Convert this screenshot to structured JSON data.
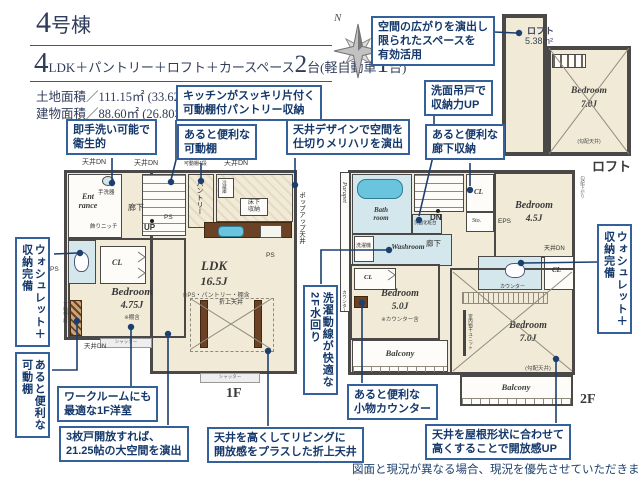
{
  "header": {
    "building_number": "4",
    "building_suffix": "号棟",
    "plan_num1": "4",
    "plan_text1": "LDK＋パントリー＋ロフト＋カースペース",
    "plan_num2": "2",
    "plan_text2": "台(軽自動車",
    "plan_num3": "1",
    "plan_text3": "台)",
    "land_area": "土地面積／111.15㎡ (33.62坪)",
    "building_area": "建物面積／88.60㎡ (26.80坪)"
  },
  "compass": {
    "north": "N"
  },
  "callouts": {
    "loft_space": "空間の広がりを演出し\n限られたスペースを\n有効活用",
    "kitchen_pantry": "キッチンがスッキリ片付く\n可動棚付パントリー収納",
    "washbasin_cabinet": "洗面吊戸で\n収納力UP",
    "handwash": "即手洗い可能で\n衛生的",
    "movable_shelf_top": "あると便利な\n可動棚",
    "ceiling_design": "天井デザインで空間を\n仕切りメリハリを演出",
    "hall_storage": "あると便利な\n廊下収納",
    "washlet_left": "ウォシュレット＋\n収納完備",
    "movable_shelf_left": "あると便利な\n可動棚",
    "workroom": "ワークルームにも\n最適な1F洋室",
    "three_doors": "3枚戸開放すれば、\n21.25帖の大空間を演出",
    "laundry_line": "洗濯動線が快適な\n2F水回り",
    "goods_counter": "あると便利な\n小物カウンター",
    "high_ceiling": "天井を高くしてリビングに\n開放感をプラスした折上天井",
    "roof_ceiling": "天井を屋根形状に合わせて\n高くすることで開放感UP",
    "washlet_right": "ウォシュレット＋\n収納完備"
  },
  "floor1": {
    "floor_label": "1F",
    "entrance": "Ent\nrance",
    "hallway": "廊下",
    "handwash_basin": "手洗器",
    "niche": "飾りニッチ",
    "up": "UP",
    "ps": "PS",
    "pantry": "パントリー",
    "fridge": "冷蔵庫",
    "underfloor": "床下\n収納",
    "ldk": "LDK",
    "ldk_size": "16.5J",
    "ldk_note": "※PS・パントリー・棚含",
    "oriage": "折上天井",
    "bedroom": "Bedroom",
    "bedroom_size": "4.75J",
    "bedroom_note": "※棚含",
    "cl": "CL",
    "shelf4": "可動棚4段",
    "ceiling_dn": "天井DN",
    "shutter": "シャッター",
    "popup_ceiling": "ポップアップ天井"
  },
  "floor2": {
    "floor_label": "2F",
    "parapet": "Parapet",
    "bathroom": "Bath\nroom",
    "washroom": "Washroom",
    "washer": "洗濯機",
    "vanity": "洗面化粧台",
    "dn": "DN",
    "hallway": "廊下",
    "cl": "CL",
    "storage": "Sto.",
    "eps": "EPS",
    "bedroom45": "Bedroom",
    "bedroom45_size": "4.5J",
    "ceiling_dn": "天井DN",
    "bedroom50": "Bedroom",
    "bedroom50_size": "5.0J",
    "bedroom50_note": "※カウンター含",
    "counter": "カウンター",
    "laundry_unit": "室内物干ユニット",
    "bedroom70": "Bedroom",
    "bedroom70_size": "7.0J",
    "sloped_ceiling": "(勾配天井)",
    "balcony": "Balcony",
    "eaves": "勾配下がり"
  },
  "loft": {
    "floor_label": "ロフト",
    "name": "ロフト",
    "area": "5.38m²",
    "bedroom": "Bedroom",
    "bedroom_size": "7.0J",
    "sloped_ceiling": "(勾配天井)"
  },
  "disclaimer": "図面と現況が異なる場合、現況を優先させていただきます。"
}
